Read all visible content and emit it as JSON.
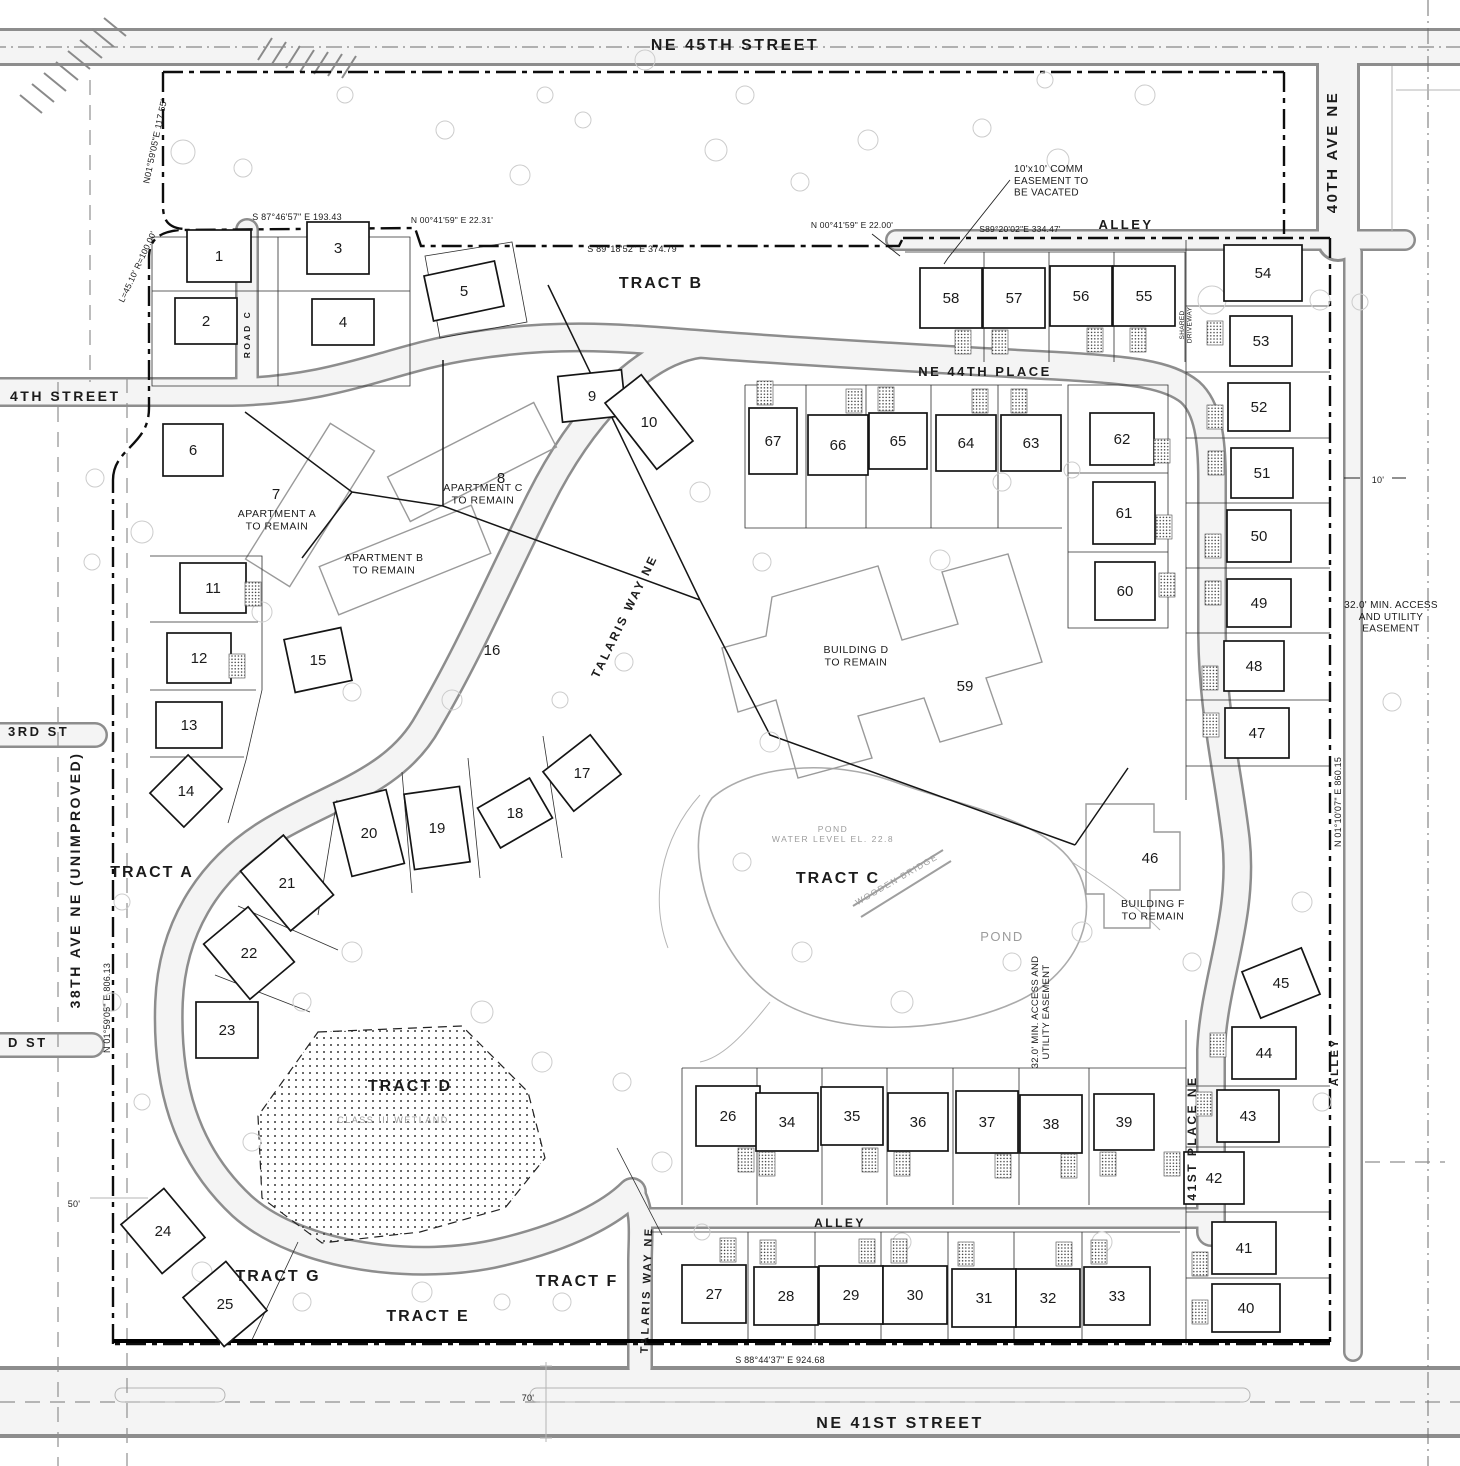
{
  "plan": {
    "street_labels": [
      {
        "text": "NE 45TH STREET",
        "x": 735,
        "y": 50,
        "size": 16
      },
      {
        "text": "40TH AVE NE",
        "x": 1337,
        "y": 152,
        "rotate": -90,
        "size": 15
      },
      {
        "text": "ALLEY",
        "x": 1126,
        "y": 229,
        "size": 13
      },
      {
        "text": "NE 44TH PLACE",
        "x": 985,
        "y": 376,
        "size": 13
      },
      {
        "text": "4TH STREET",
        "x": 10,
        "y": 401,
        "align": "start",
        "size": 14
      },
      {
        "text": "3RD ST",
        "x": 8,
        "y": 736,
        "align": "start",
        "size": 13
      },
      {
        "text": "D ST",
        "x": 8,
        "y": 1047,
        "align": "start",
        "size": 13
      },
      {
        "text": "38TH AVE NE (UNIMPROVED)",
        "x": 80,
        "y": 880,
        "rotate": -90,
        "size": 14
      },
      {
        "text": "ROAD C",
        "x": 250,
        "y": 334,
        "rotate": -90,
        "size": 8.5
      },
      {
        "text": "TALARIS WAY NE",
        "x": 628,
        "y": 618,
        "rotate": -64,
        "size": 12
      },
      {
        "text": "TALARIS WAY NE",
        "x": 650,
        "y": 1290,
        "rotate": -88,
        "size": 11
      },
      {
        "text": "41ST PLACE NE",
        "x": 1196,
        "y": 1138,
        "rotate": -90,
        "size": 12
      },
      {
        "text": "ALLEY",
        "x": 1338,
        "y": 1062,
        "rotate": -90,
        "size": 11
      },
      {
        "text": "ALLEY",
        "x": 840,
        "y": 1227,
        "size": 12
      },
      {
        "text": "NE 41ST STREET",
        "x": 900,
        "y": 1428,
        "size": 16
      }
    ],
    "tract_labels": [
      {
        "text": "TRACT A",
        "x": 152,
        "y": 877
      },
      {
        "text": "TRACT B",
        "x": 661,
        "y": 288
      },
      {
        "text": "TRACT C",
        "x": 838,
        "y": 883
      },
      {
        "text": "TRACT D",
        "x": 410,
        "y": 1091
      },
      {
        "text": "TRACT E",
        "x": 428,
        "y": 1321
      },
      {
        "text": "TRACT F",
        "x": 577,
        "y": 1286
      },
      {
        "text": "TRACT G",
        "x": 278,
        "y": 1281
      }
    ],
    "building_labels": [
      {
        "lines": [
          "APARTMENT A",
          "TO REMAIN"
        ],
        "x": 277,
        "y": 517
      },
      {
        "lines": [
          "APARTMENT B",
          "TO REMAIN"
        ],
        "x": 384,
        "y": 561
      },
      {
        "lines": [
          "APARTMENT C",
          "TO REMAIN"
        ],
        "x": 483,
        "y": 491
      },
      {
        "lines": [
          "BUILDING D",
          "TO REMAIN"
        ],
        "x": 856,
        "y": 653
      },
      {
        "lines": [
          "BUILDING F",
          "TO REMAIN"
        ],
        "x": 1153,
        "y": 907
      }
    ],
    "water_labels": [
      {
        "lines": [
          "POND",
          "WATER LEVEL EL. 22.8"
        ],
        "x": 833,
        "y": 832,
        "size": 8.5
      },
      {
        "lines": [
          "POND"
        ],
        "x": 1002,
        "y": 941,
        "size": 13
      },
      {
        "lines": [
          "WOODEN BRIDGE"
        ],
        "x": 898,
        "y": 882,
        "rotate": -30,
        "size": 8.5
      },
      {
        "lines": [
          "CLASS III WETLAND"
        ],
        "x": 393,
        "y": 1123,
        "size": 9
      }
    ],
    "annotations": [
      {
        "lines": [
          "10'x10' COMM",
          "EASEMENT TO",
          "BE VACATED"
        ],
        "x": 1014,
        "y": 172,
        "align": "start",
        "size": 10
      },
      {
        "lines": [
          "32.0' MIN. ACCESS",
          "AND UTILITY",
          "EASEMENT"
        ],
        "x": 1391,
        "y": 608,
        "size": 10
      },
      {
        "lines": [
          "32.0' MIN. ACCESS AND",
          "UTILITY EASEMENT"
        ],
        "x": 1038,
        "y": 1012,
        "rotate": -90,
        "size": 9.5
      },
      {
        "lines": [
          "SHARED",
          "DRIVEWAY"
        ],
        "x": 1184,
        "y": 325,
        "rotate": -90,
        "size": 6.5
      }
    ],
    "bearings": [
      {
        "text": "N01°59'05\"E  117.55'",
        "x": 158,
        "y": 142,
        "rotate": -78,
        "size": 9
      },
      {
        "text": "L=45.10'  R=100.00'",
        "x": 140,
        "y": 268,
        "rotate": -65,
        "size": 8.5
      },
      {
        "text": "S 87°46'57\" E  193.43",
        "x": 297,
        "y": 220,
        "size": 9
      },
      {
        "text": "N 00°41'59\" E  22.31'",
        "x": 452,
        "y": 223,
        "size": 8.5
      },
      {
        "text": "S 89°18'52\" E  374.79",
        "x": 632,
        "y": 252,
        "size": 9
      },
      {
        "text": "N 00°41'59\" E  22.00'",
        "x": 852,
        "y": 228,
        "size": 8.5
      },
      {
        "text": "S89°20'02\"E  334.47'",
        "x": 1020,
        "y": 232,
        "size": 8.5
      },
      {
        "text": "N 01°59'05\" E  806.13",
        "x": 110,
        "y": 1008,
        "rotate": -90,
        "size": 9
      },
      {
        "text": "N 01°10'07\" E  860.15",
        "x": 1341,
        "y": 802,
        "rotate": -90,
        "size": 9
      },
      {
        "text": "S 88°44'37\" E  924.68",
        "x": 780,
        "y": 1363,
        "size": 9
      }
    ],
    "dimensions": [
      {
        "text": "50'",
        "x": 74,
        "y": 1207,
        "size": 9
      },
      {
        "text": "70'",
        "x": 528,
        "y": 1401,
        "size": 9
      },
      {
        "text": "10'",
        "x": 1378,
        "y": 483,
        "size": 9
      }
    ],
    "lots": [
      {
        "n": 1,
        "x": 219,
        "y": 256,
        "w": 64,
        "h": 52
      },
      {
        "n": 2,
        "x": 206,
        "y": 321,
        "w": 62,
        "h": 46
      },
      {
        "n": 3,
        "x": 338,
        "y": 248,
        "w": 62,
        "h": 52
      },
      {
        "n": 4,
        "x": 343,
        "y": 322,
        "w": 62,
        "h": 46
      },
      {
        "n": 5,
        "x": 464,
        "y": 291,
        "w": 72,
        "h": 46,
        "a": -12
      },
      {
        "n": 6,
        "x": 193,
        "y": 450,
        "w": 60,
        "h": 52
      },
      {
        "n": 7,
        "x": 276,
        "y": 494,
        "plain": true
      },
      {
        "n": 8,
        "x": 501,
        "y": 478,
        "plain": true
      },
      {
        "n": 9,
        "x": 592,
        "y": 396,
        "w": 64,
        "h": 46,
        "a": -6
      },
      {
        "n": 10,
        "x": 649,
        "y": 422,
        "w": 46,
        "h": 84,
        "a": -38
      },
      {
        "n": 11,
        "x": 213,
        "y": 588,
        "w": 66,
        "h": 50,
        "d": [
          40,
          6
        ]
      },
      {
        "n": 12,
        "x": 199,
        "y": 658,
        "w": 64,
        "h": 50,
        "d": [
          38,
          8
        ]
      },
      {
        "n": 13,
        "x": 189,
        "y": 725,
        "w": 66,
        "h": 46
      },
      {
        "n": 14,
        "x": 186,
        "y": 791,
        "w": 54,
        "h": 48,
        "a": -45
      },
      {
        "n": 15,
        "x": 318,
        "y": 660,
        "w": 58,
        "h": 54,
        "a": -12
      },
      {
        "n": 16,
        "x": 492,
        "y": 650,
        "plain": true
      },
      {
        "n": 17,
        "x": 582,
        "y": 773,
        "w": 60,
        "h": 50,
        "a": -38
      },
      {
        "n": 18,
        "x": 515,
        "y": 813,
        "w": 60,
        "h": 46,
        "a": -30
      },
      {
        "n": 19,
        "x": 437,
        "y": 828,
        "w": 56,
        "h": 76,
        "a": -8
      },
      {
        "n": 20,
        "x": 369,
        "y": 833,
        "w": 54,
        "h": 76,
        "a": -14
      },
      {
        "n": 21,
        "x": 287,
        "y": 883,
        "w": 56,
        "h": 78,
        "a": -40
      },
      {
        "n": 22,
        "x": 249,
        "y": 953,
        "w": 58,
        "h": 72,
        "a": -40
      },
      {
        "n": 23,
        "x": 227,
        "y": 1030,
        "w": 62,
        "h": 56
      },
      {
        "n": 24,
        "x": 163,
        "y": 1231,
        "w": 56,
        "h": 64,
        "a": -40
      },
      {
        "n": 25,
        "x": 225,
        "y": 1304,
        "w": 56,
        "h": 64,
        "a": -40
      },
      {
        "n": 26,
        "x": 728,
        "y": 1116,
        "w": 64,
        "h": 60,
        "d": [
          18,
          44
        ]
      },
      {
        "n": 27,
        "x": 714,
        "y": 1294,
        "w": 64,
        "h": 58,
        "d": [
          14,
          -44
        ]
      },
      {
        "n": 28,
        "x": 786,
        "y": 1296,
        "w": 64,
        "h": 58,
        "d": [
          -18,
          -44
        ]
      },
      {
        "n": 29,
        "x": 851,
        "y": 1295,
        "w": 64,
        "h": 58,
        "d": [
          16,
          -44
        ]
      },
      {
        "n": 30,
        "x": 915,
        "y": 1295,
        "w": 64,
        "h": 58,
        "d": [
          -16,
          -44
        ]
      },
      {
        "n": 31,
        "x": 984,
        "y": 1298,
        "w": 64,
        "h": 58,
        "d": [
          -18,
          -44
        ]
      },
      {
        "n": 32,
        "x": 1048,
        "y": 1298,
        "w": 64,
        "h": 58,
        "d": [
          16,
          -44
        ]
      },
      {
        "n": 33,
        "x": 1117,
        "y": 1296,
        "w": 66,
        "h": 58,
        "d": [
          -18,
          -44
        ]
      },
      {
        "n": 34,
        "x": 787,
        "y": 1122,
        "w": 62,
        "h": 58,
        "d": [
          -20,
          42
        ]
      },
      {
        "n": 35,
        "x": 852,
        "y": 1116,
        "w": 62,
        "h": 58,
        "d": [
          18,
          44
        ]
      },
      {
        "n": 36,
        "x": 918,
        "y": 1122,
        "w": 60,
        "h": 58,
        "d": [
          -16,
          42
        ]
      },
      {
        "n": 37,
        "x": 987,
        "y": 1122,
        "w": 62,
        "h": 62,
        "d": [
          16,
          44
        ]
      },
      {
        "n": 38,
        "x": 1051,
        "y": 1124,
        "w": 62,
        "h": 58,
        "d": [
          18,
          42
        ]
      },
      {
        "n": 39,
        "x": 1124,
        "y": 1122,
        "w": 60,
        "h": 56,
        "d": [
          -16,
          42
        ]
      },
      {
        "n": 40,
        "x": 1246,
        "y": 1308,
        "w": 68,
        "h": 48,
        "d": [
          -46,
          4
        ]
      },
      {
        "n": 41,
        "x": 1244,
        "y": 1248,
        "w": 64,
        "h": 52,
        "d": [
          -44,
          16
        ]
      },
      {
        "n": 42,
        "x": 1214,
        "y": 1178,
        "w": 60,
        "h": 52,
        "d": [
          -42,
          -14
        ]
      },
      {
        "n": 43,
        "x": 1248,
        "y": 1116,
        "w": 62,
        "h": 52,
        "d": [
          -44,
          -12
        ]
      },
      {
        "n": 44,
        "x": 1264,
        "y": 1053,
        "w": 64,
        "h": 52,
        "d": [
          -46,
          -8
        ]
      },
      {
        "n": 45,
        "x": 1281,
        "y": 983,
        "w": 64,
        "h": 50,
        "a": -22
      },
      {
        "n": 46,
        "x": 1150,
        "y": 858,
        "plain": true
      },
      {
        "n": 47,
        "x": 1257,
        "y": 733,
        "w": 64,
        "h": 50,
        "d": [
          -46,
          -8
        ]
      },
      {
        "n": 48,
        "x": 1254,
        "y": 666,
        "w": 60,
        "h": 50,
        "d": [
          -44,
          12
        ]
      },
      {
        "n": 49,
        "x": 1259,
        "y": 603,
        "w": 64,
        "h": 48,
        "d": [
          -46,
          -10
        ]
      },
      {
        "n": 50,
        "x": 1259,
        "y": 536,
        "w": 64,
        "h": 52,
        "d": [
          -46,
          10
        ]
      },
      {
        "n": 51,
        "x": 1262,
        "y": 473,
        "w": 62,
        "h": 50,
        "d": [
          -46,
          -10
        ]
      },
      {
        "n": 52,
        "x": 1259,
        "y": 407,
        "w": 62,
        "h": 48,
        "d": [
          -44,
          10
        ]
      },
      {
        "n": 53,
        "x": 1261,
        "y": 341,
        "w": 62,
        "h": 50,
        "d": [
          -46,
          -8
        ]
      },
      {
        "n": 54,
        "x": 1263,
        "y": 273,
        "w": 78,
        "h": 56
      },
      {
        "n": 55,
        "x": 1144,
        "y": 296,
        "w": 62,
        "h": 60,
        "d": [
          -6,
          44
        ]
      },
      {
        "n": 56,
        "x": 1081,
        "y": 296,
        "w": 62,
        "h": 60,
        "d": [
          14,
          44
        ]
      },
      {
        "n": 57,
        "x": 1014,
        "y": 298,
        "w": 62,
        "h": 60,
        "d": [
          -14,
          44
        ]
      },
      {
        "n": 58,
        "x": 951,
        "y": 298,
        "w": 62,
        "h": 60,
        "d": [
          12,
          44
        ]
      },
      {
        "n": 59,
        "x": 965,
        "y": 686,
        "plain": true
      },
      {
        "n": 60,
        "x": 1125,
        "y": 591,
        "w": 60,
        "h": 58,
        "d": [
          42,
          -6
        ]
      },
      {
        "n": 61,
        "x": 1124,
        "y": 513,
        "w": 62,
        "h": 62,
        "d": [
          40,
          14
        ]
      },
      {
        "n": 62,
        "x": 1122,
        "y": 439,
        "w": 64,
        "h": 52,
        "d": [
          40,
          12
        ]
      },
      {
        "n": 63,
        "x": 1031,
        "y": 443,
        "w": 60,
        "h": 56,
        "d": [
          -12,
          -42
        ]
      },
      {
        "n": 64,
        "x": 966,
        "y": 443,
        "w": 60,
        "h": 56,
        "d": [
          14,
          -42
        ]
      },
      {
        "n": 65,
        "x": 898,
        "y": 441,
        "w": 58,
        "h": 56,
        "d": [
          -12,
          -42
        ]
      },
      {
        "n": 66,
        "x": 838,
        "y": 445,
        "w": 60,
        "h": 60,
        "d": [
          16,
          -44
        ]
      },
      {
        "n": 67,
        "x": 773,
        "y": 441,
        "w": 48,
        "h": 66,
        "d": [
          -8,
          -48
        ]
      }
    ]
  }
}
